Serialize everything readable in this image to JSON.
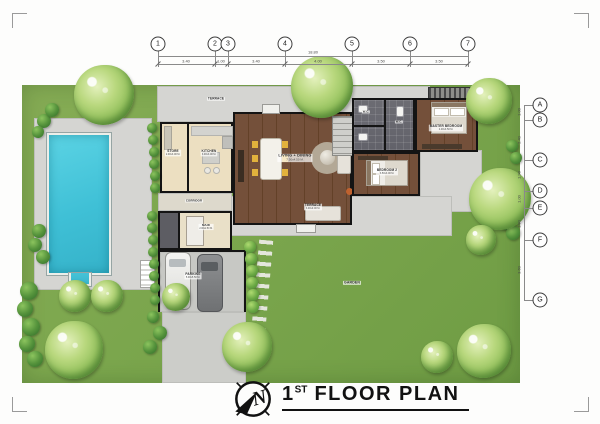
{
  "title": {
    "number": "1",
    "ordinal": "ST",
    "text": "FLOOR PLAN"
  },
  "compass": {
    "letter": "N"
  },
  "grid": {
    "top": [
      "1",
      "2",
      "3",
      "4",
      "5",
      "6",
      "7"
    ],
    "right": [
      "A",
      "B",
      "C",
      "D",
      "E",
      "F",
      "G"
    ]
  },
  "dimensions": {
    "top_overall": "18.80",
    "top_segments": [
      "3.40",
      "1.00",
      "3.40",
      "4.00",
      "3.50",
      "3.50"
    ],
    "right_segments": [
      "1.00",
      "2.40",
      "1.90",
      "1.00",
      "1.90",
      "3.60"
    ]
  },
  "rooms": {
    "terrace_top": {
      "label": "TERRACE"
    },
    "store": {
      "label": "STORE",
      "size": "2.00x3.00 M."
    },
    "kitchen": {
      "label": "KITCHEN",
      "size": "3.00x3.00 M."
    },
    "living_dining": {
      "label": "LIVING + DINING",
      "size": "7.50x4.50 M."
    },
    "wc": {
      "label": "W.C."
    },
    "master_bedroom": {
      "label": "MASTER BEDROOM",
      "size": "4.00x3.50 M."
    },
    "bedroom2": {
      "label": "BEDROOM 2",
      "size": "3.50x3.00 M."
    },
    "corridor": {
      "label": "CORRIDOR"
    },
    "maid": {
      "label": "MAID",
      "size": "2.00x2.50 M."
    },
    "parking": {
      "label": "PARKING",
      "size": "5.00x5.50 M."
    },
    "terrace_south": {
      "label": "TERRACE",
      "size": "3.00x9.00 M."
    },
    "garden": {
      "label": "GARDEN"
    }
  },
  "colors": {
    "lawn": "#7ba64d",
    "pool_water": "#45c4d8",
    "paving": "#d5d5d2",
    "wood_floor": "#6f4b34",
    "tile": "#65656c",
    "beige_floor": "#ecdfc1",
    "tree_light": "#a8cd6b",
    "tree_dark": "#4e8f3a"
  }
}
